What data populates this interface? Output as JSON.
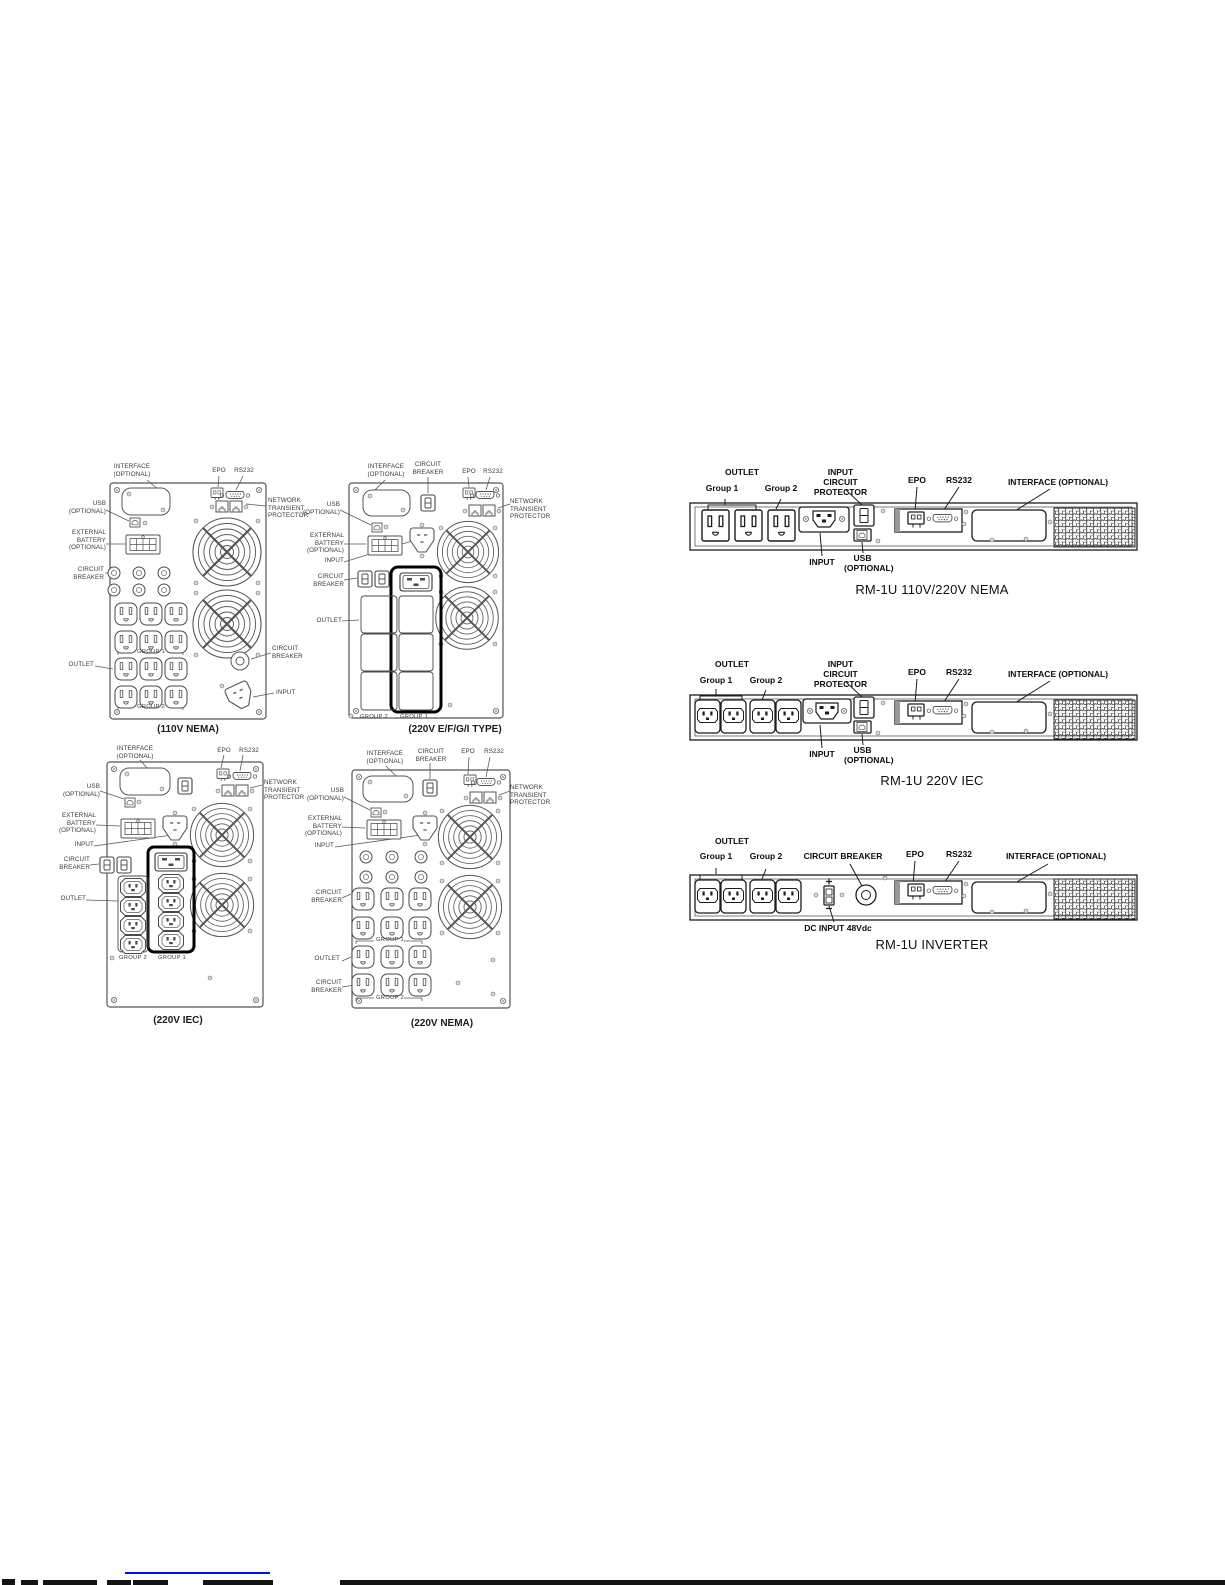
{
  "towers": {
    "nema110": {
      "caption": "(110V NEMA)",
      "labels": {
        "interface": "INTERFACE\n(OPTIONAL)",
        "epo": "EPO",
        "rs232": "RS232",
        "network": "NETWORK\nTRANSIENT\nPROTECTOR",
        "usb": "USB\n(OPTIONAL)",
        "battery": "EXTERNAL\nBATTERY\n(OPTIONAL)",
        "breaker": "CIRCUIT\nBREAKER",
        "outlet": "OUTLET",
        "breaker_right": "CIRCUIT\nBREAKER",
        "input": "INPUT",
        "group1": "GROUP 1",
        "group2": "GROUP 2"
      }
    },
    "efgi220": {
      "caption": "(220V E/F/G/I TYPE)",
      "labels": {
        "interface": "INTERFACE\n(OPTIONAL)",
        "breaker_top": "CIRCUIT\nBREAKER",
        "epo": "EPO",
        "rs232": "RS232",
        "network": "NETWORK\nTRANSIENT\nPROTECTOR",
        "usb": "USB\n(OPTIONAL)",
        "battery": "EXTERNAL\nBATTERY\n(OPTIONAL)",
        "input": "INPUT",
        "breaker": "CIRCUIT\nBREAKER",
        "outlet": "OUTLET",
        "group2": "GROUP 2",
        "group1": "GROUP 1"
      }
    },
    "iec220": {
      "caption": "(220V IEC)",
      "labels": {
        "interface": "INTERFACE\n(OPTIONAL)",
        "epo": "EPO",
        "rs232": "RS232",
        "network": "NETWORK\nTRANSIENT\nPROTECTOR",
        "usb": "USB\n(OPTIONAL)",
        "battery": "EXTERNAL\nBATTERY\n(OPTIONAL)",
        "input": "INPUT",
        "breaker": "CIRCUIT\nBREAKER",
        "outlet": "OUTLET",
        "group2": "GROUP 2",
        "group1": "GROUP 1"
      }
    },
    "nema220": {
      "caption": "(220V NEMA)",
      "labels": {
        "interface": "INTERFACE\n(OPTIONAL)",
        "breaker_top": "CIRCUIT\nBREAKER",
        "epo": "EPO",
        "rs232": "RS232",
        "network": "NETWORK\nTRANSIENT\nPROTECTOR",
        "usb": "USB\n(OPTIONAL)",
        "battery": "EXTERNAL\nBATTERY\n(OPTIONAL)",
        "input": "INPUT",
        "breaker": "CIRCUIT\nBREAKER",
        "outlet": "OUTLET",
        "breaker_bottom": "CIRCUIT\nBREAKER",
        "group1": "GROUP 1",
        "group2": "GROUP 2"
      }
    }
  },
  "racks": {
    "nema": {
      "caption": "RM-1U 110V/220V NEMA",
      "labels": {
        "outlet": "OUTLET",
        "group1": "Group 1",
        "group2": "Group 2",
        "icp": "INPUT\nCIRCUIT PROTECTOR",
        "epo": "EPO",
        "rs232": "RS232",
        "interface": "INTERFACE (OPTIONAL)",
        "input": "INPUT",
        "usb": "USB\n(OPTIONAL)"
      }
    },
    "iec": {
      "caption": "RM-1U 220V IEC",
      "labels": {
        "outlet": "OUTLET",
        "group1": "Group 1",
        "group2": "Group 2",
        "icp": "INPUT\nCIRCUIT PROTECTOR",
        "epo": "EPO",
        "rs232": "RS232",
        "interface": "INTERFACE (OPTIONAL)",
        "input": "INPUT",
        "usb": "USB\n(OPTIONAL)"
      }
    },
    "inverter": {
      "caption": "RM-1U INVERTER",
      "labels": {
        "outlet": "OUTLET",
        "group1": "Group 1",
        "group2": "Group 2",
        "breaker": "CIRCUIT BREAKER",
        "epo": "EPO",
        "rs232": "RS232",
        "interface": "INTERFACE (OPTIONAL)",
        "dc_input": "DC INPUT 48Vdc"
      }
    }
  }
}
